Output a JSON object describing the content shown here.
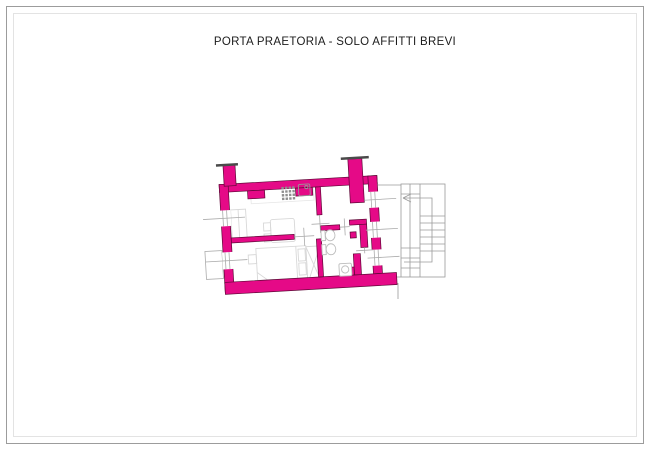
{
  "page": {
    "title": "PORTA PRAETORIA - SOLO AFFITTI BREVI"
  },
  "drawing": {
    "type": "apartment-floor-plan",
    "wall_style": "solid magenta filled walls, plan rotated slightly counter-clockwise",
    "features": [
      "kitchen-living-room",
      "bedroom",
      "bathroom",
      "hallway",
      "external-staircase"
    ]
  },
  "icons": {
    "stove": "burner-grid",
    "sink": "square-basin-with-drain",
    "toilet": "oval-fixture",
    "bidet": "oval-fixture",
    "washbasin": "square-with-circle",
    "stair_direction_arrow": "arrow-pointing-left"
  },
  "colors": {
    "background": "#FFFFFF",
    "frame_outer": "#9C9C9C",
    "frame_inner": "#E3E3E3",
    "title_text": "#1C1C1C",
    "wall_fill": "#E50A87",
    "wall_stroke": "#5F0837",
    "cap_stroke": "#4A4A4A",
    "furniture_line": "#D8D8D8",
    "fixture_line": "#BDBDBD",
    "appliance_line": "#8F8F8F",
    "opening_line": "#ABABAB",
    "stair_line": "#9A9A9A"
  }
}
